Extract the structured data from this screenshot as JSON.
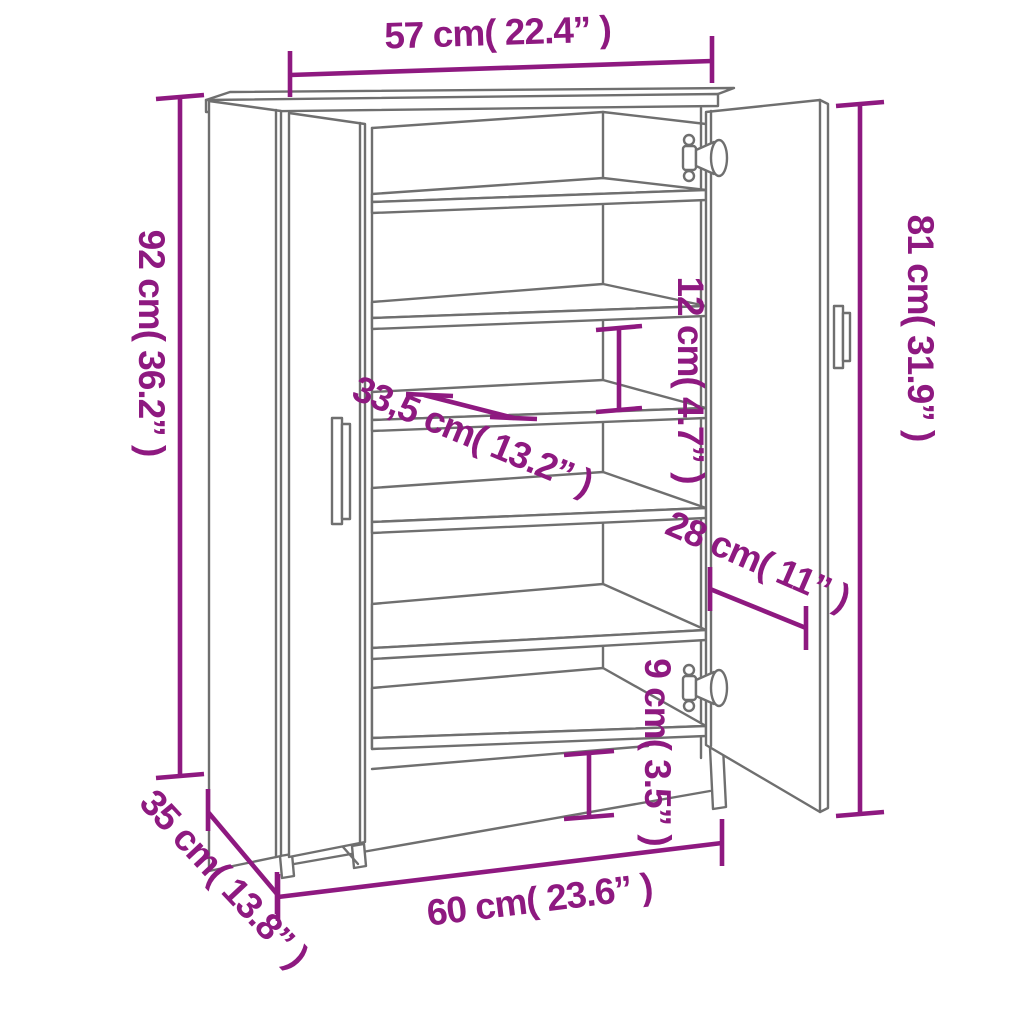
{
  "figure": {
    "type": "furniture dimension diagram",
    "subject": "shoe cabinet with two open doors and interior shelves",
    "background_color": "#ffffff",
    "drawing_line_color": "#6f6f6f",
    "annotation_color": "#8e1980"
  },
  "dimensions": [
    {
      "id": "top-width",
      "label": "57 cm( 22.4” )"
    },
    {
      "id": "left-height",
      "label": "92 cm( 36.2” )"
    },
    {
      "id": "right-height",
      "label": "81 cm( 31.9” )"
    },
    {
      "id": "shelf-gap",
      "label": "12 cm( 4.7” )"
    },
    {
      "id": "shelf-depth",
      "label": "33,5 cm( 13.2” )"
    },
    {
      "id": "door-width",
      "label": "28 cm( 11” )"
    },
    {
      "id": "plinth-height",
      "label": "9 cm( 3.5” )"
    },
    {
      "id": "bottom-width",
      "label": "60 cm( 23.6” )"
    },
    {
      "id": "side-depth",
      "label": "35 cm( 13.8” )"
    }
  ]
}
